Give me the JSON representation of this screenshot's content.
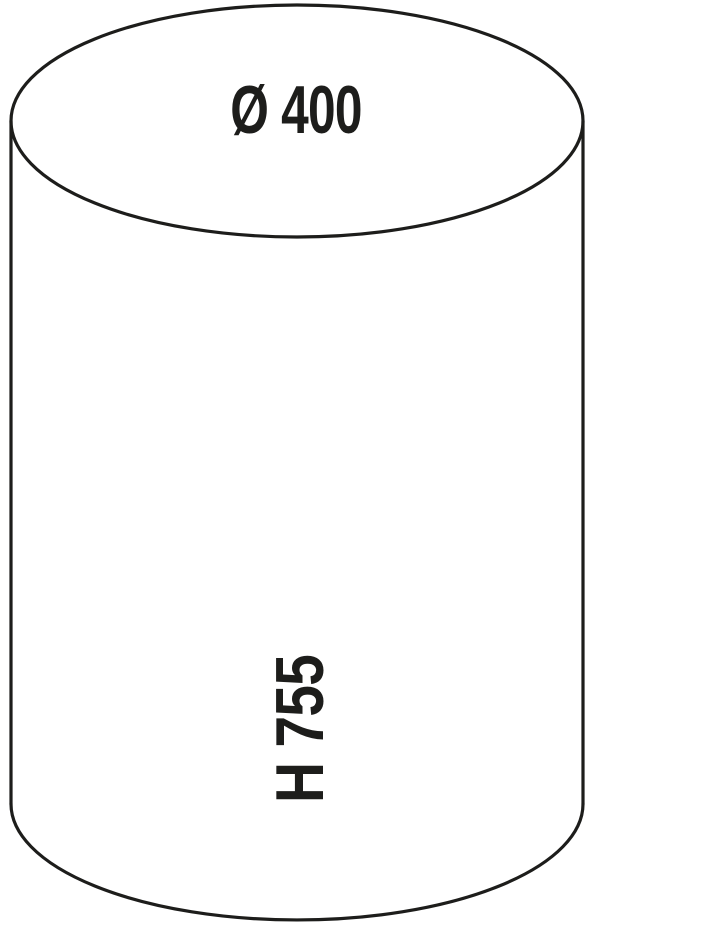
{
  "diagram": {
    "shape": "cylinder",
    "line_color": "#1d1d1b",
    "background_color": "#ffffff",
    "diameter_label": "Ø 400",
    "height_label": "H 755",
    "diameter_value": 400,
    "height_value": 755
  }
}
